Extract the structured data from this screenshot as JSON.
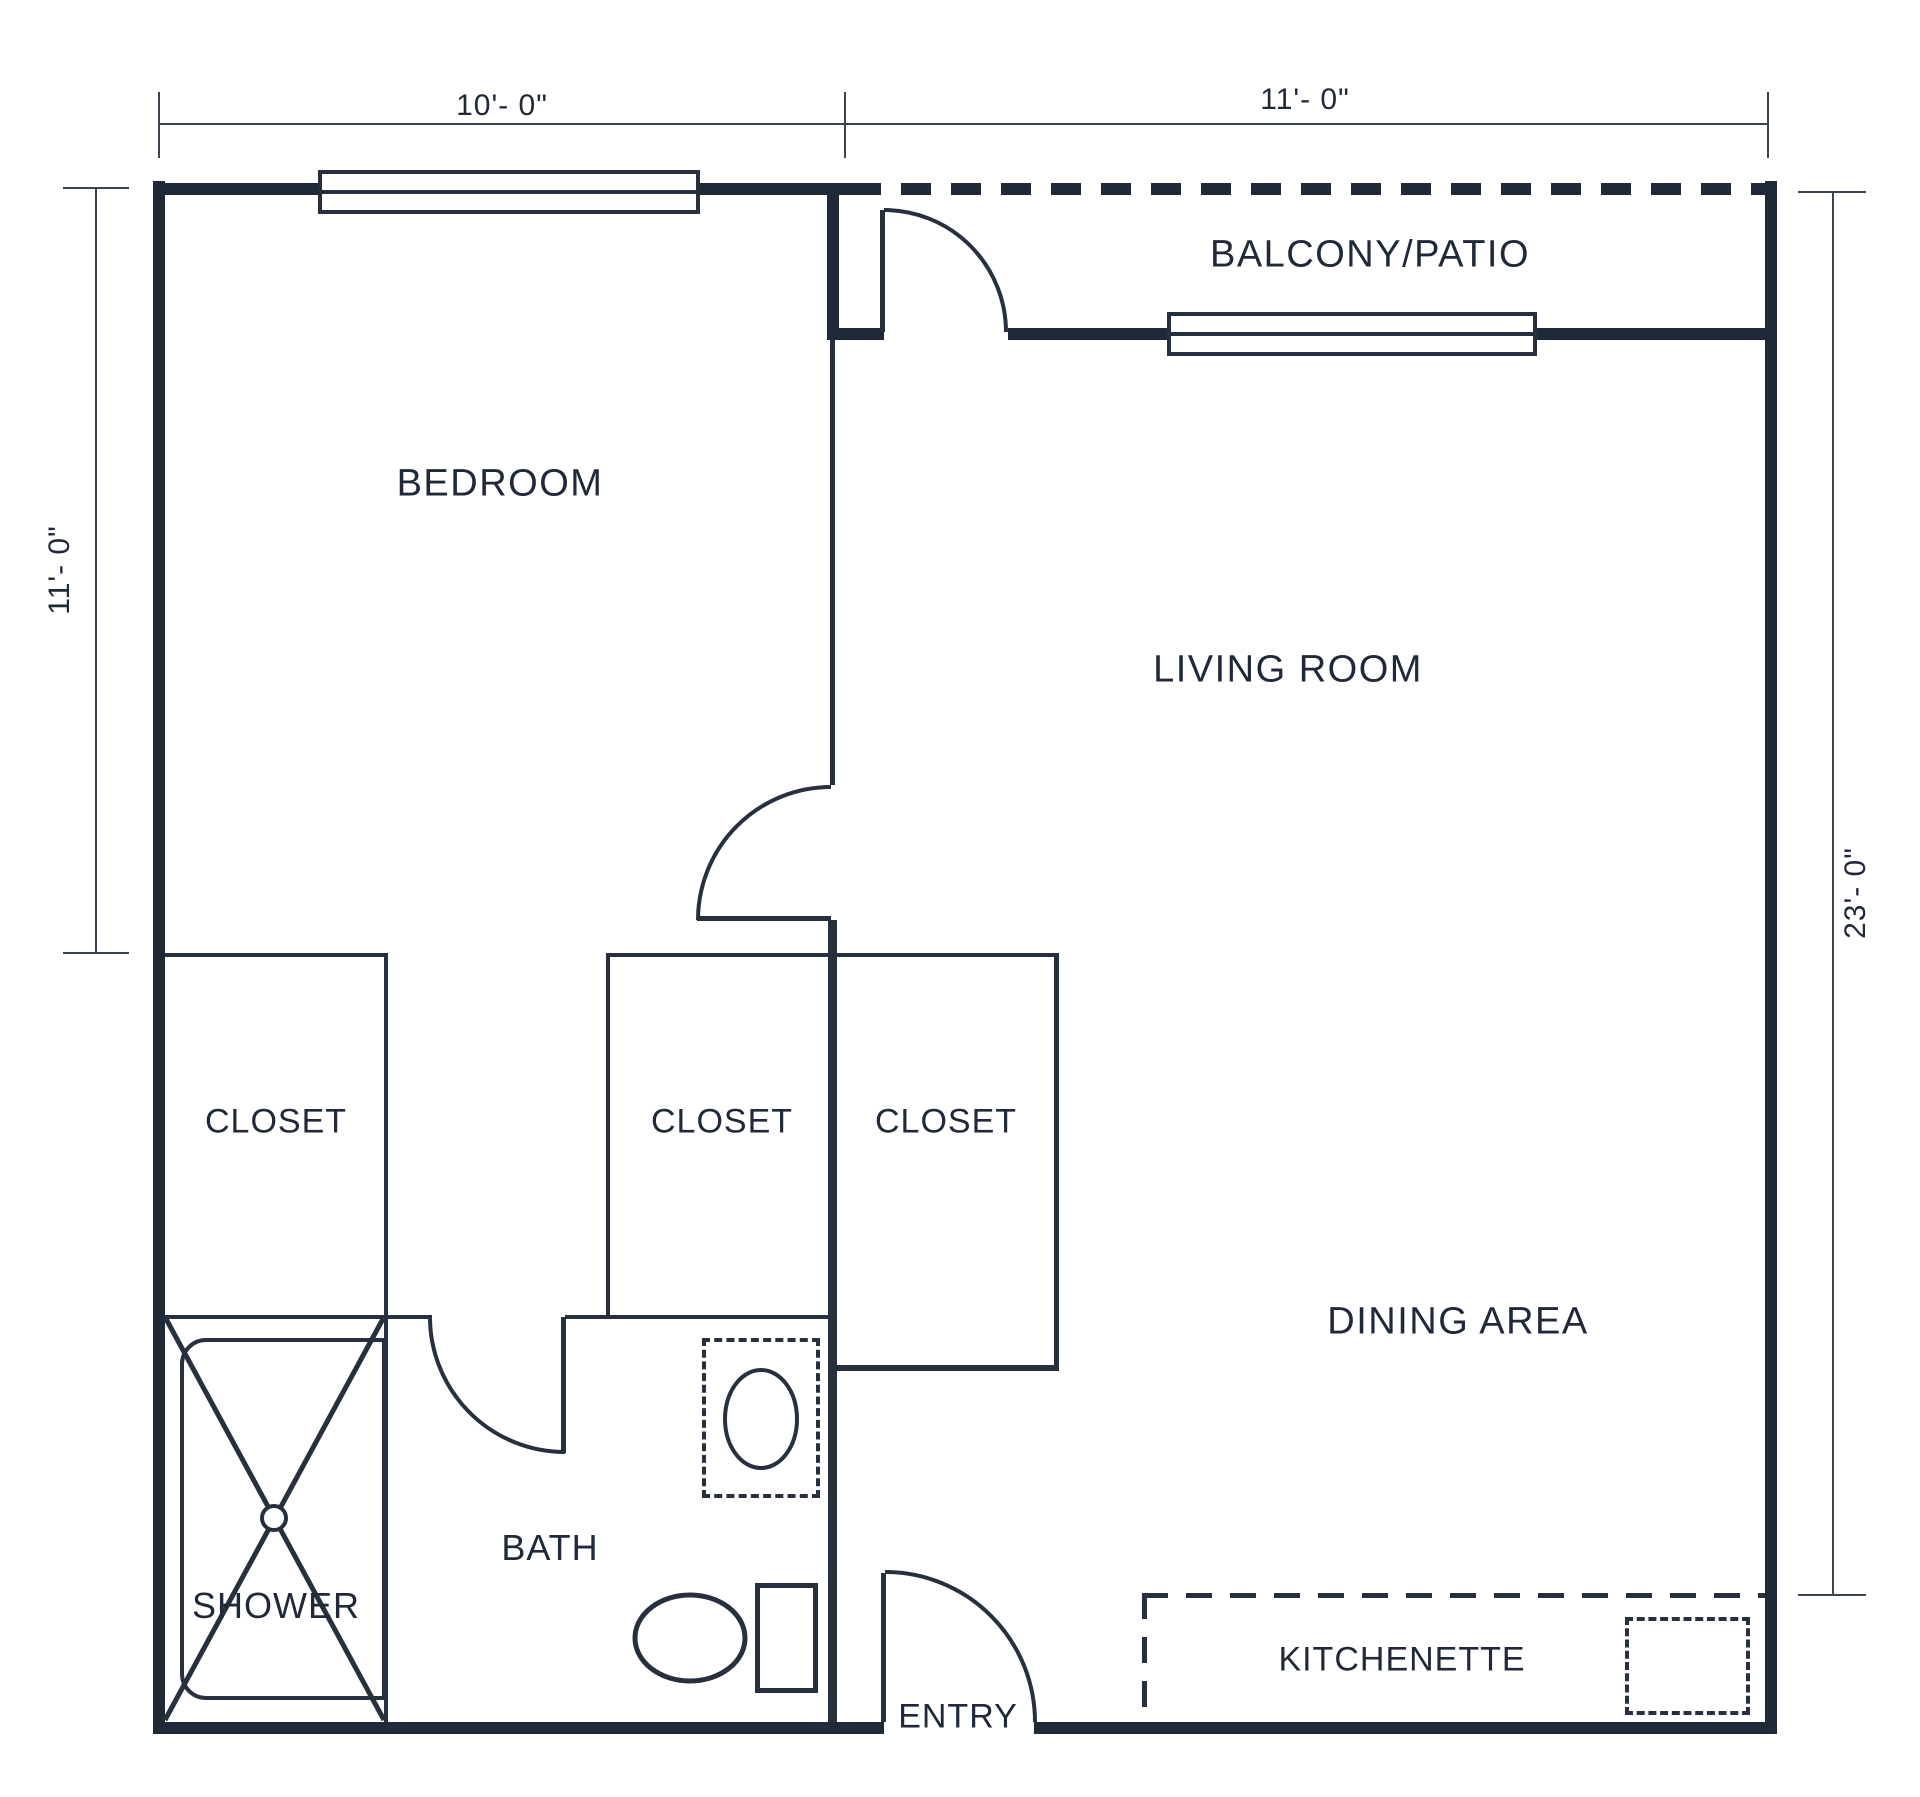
{
  "labels": {
    "bedroom": "BEDROOM",
    "balcony_patio": "BALCONY/PATIO",
    "living_room": "LIVING ROOM",
    "dining_area": "DINING AREA",
    "closet_left": "CLOSET",
    "closet_middle": "CLOSET",
    "closet_right": "CLOSET",
    "shower": "SHOWER",
    "bath": "BATH",
    "entry": "ENTRY",
    "kitchenette": "KITCHENETTE"
  },
  "dimensions": {
    "top_left_width": "10'- 0\"",
    "top_right_width": "11'- 0\"",
    "left_height": "11'- 0\"",
    "right_height": "23'- 0\""
  },
  "colors": {
    "wall": "#1f2a38",
    "line": "#27303f",
    "text": "#20293a",
    "background": "#ffffff"
  }
}
